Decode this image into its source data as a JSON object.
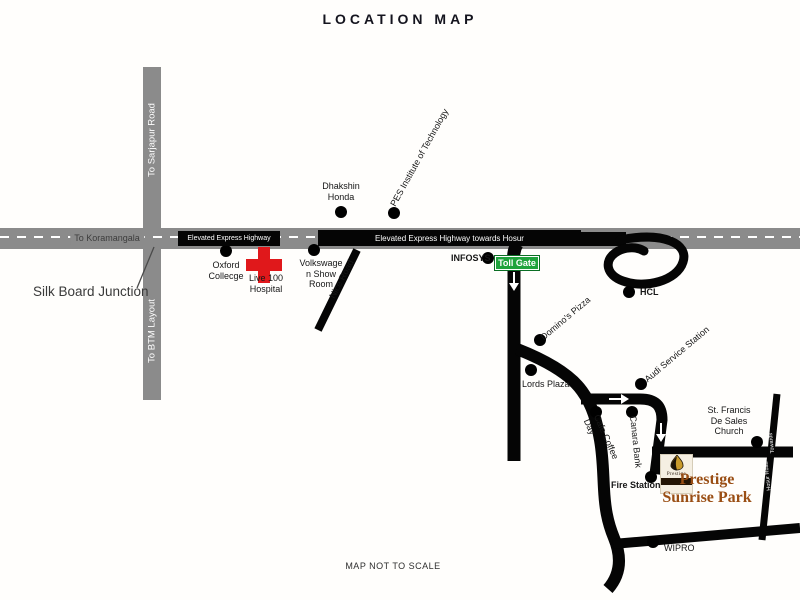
{
  "title": "LOCATION MAP",
  "footer": "MAP NOT TO SCALE",
  "colors": {
    "road_gray": "#8b8b8b",
    "highway_black": "#050505",
    "toll_green": "#1fa33c",
    "hospital_cross_red": "#e0181b",
    "prestige_brown": "#9a4e14"
  },
  "roads": {
    "sarjapur": "To Sarjapur Road",
    "btm": "To BTM Layout",
    "koramangala": "To Koramangala",
    "silk_board_junction": "Silk Board Junction",
    "highway_left": "Elevated Express Highway",
    "highway_right": "Elevated Express Highway towards Hosur",
    "nice_road": "Nice Road",
    "hosur_upper": "Towards",
    "hosur_lower": "Hosur Road"
  },
  "toll_gate": {
    "label": "Toll Gate"
  },
  "pois": {
    "oxford": "Oxford\nCollecge",
    "hospital": "Live 100\nHospital",
    "volkswagen": "Volkswage\nn Show\nRoom",
    "dhakshin": "Dhakshin\nHonda",
    "pes": "PES Institute of Technology",
    "infosys": "INFOSYS",
    "hcl": "HCL",
    "dominos": "Domino's Pizza",
    "lords": "Lords Plaza",
    "audi": "Audi Service Station",
    "ccd": "Cafe Coffee\nDay",
    "canara": "Canara Bank",
    "fire": "Fire Station",
    "church": "St. Francis\nDe Sales\nChurch",
    "wipro": "WIPRO",
    "prestige": "Prestige\nSunrise Park"
  },
  "logo": {
    "name": "Prestige"
  }
}
